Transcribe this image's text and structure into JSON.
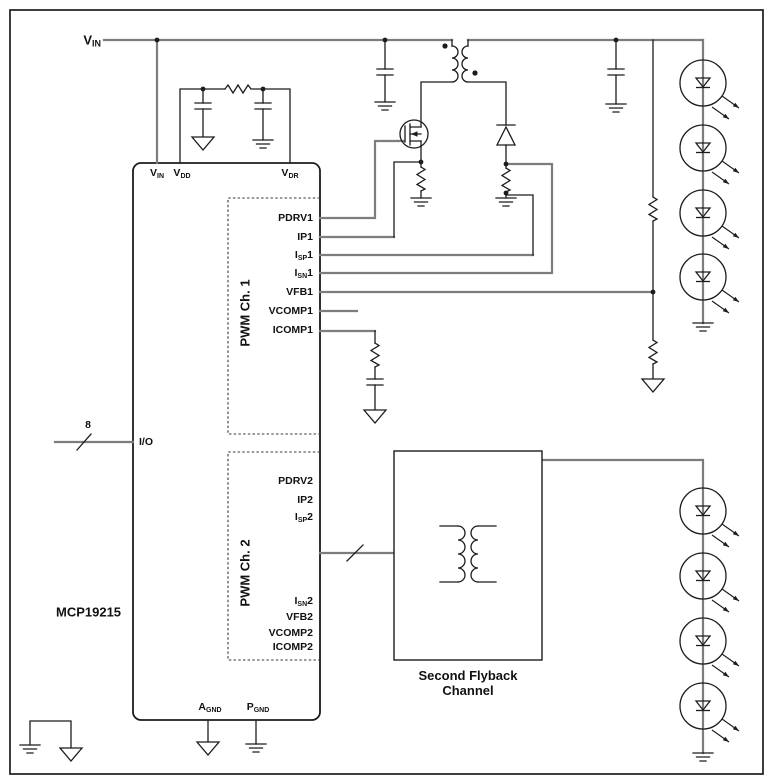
{
  "nets": {
    "vin": {
      "pre": "V",
      "sub": "IN"
    },
    "io_bus_width": "8"
  },
  "chip": {
    "name": "MCP19215",
    "top_pins": [
      {
        "pre": "V",
        "sub": "IN"
      },
      {
        "pre": "V",
        "sub": "DD"
      },
      {
        "pre": "V",
        "sub": "DR"
      }
    ],
    "left_pins": [
      {
        "pre": "I/O",
        "sub": ""
      }
    ],
    "bottom_pins": [
      {
        "pre": "A",
        "sub": "GND"
      },
      {
        "pre": "P",
        "sub": "GND"
      }
    ],
    "pwm_ch1": {
      "label": "PWM Ch. 1",
      "pins": [
        {
          "pre": "PDRV1",
          "sub": "",
          "post": ""
        },
        {
          "pre": "IP1",
          "sub": "",
          "post": ""
        },
        {
          "pre": "I",
          "sub": "SP",
          "post": "1"
        },
        {
          "pre": "I",
          "sub": "SN",
          "post": "1"
        },
        {
          "pre": "VFB1",
          "sub": "",
          "post": ""
        },
        {
          "pre": "VCOMP1",
          "sub": "",
          "post": ""
        },
        {
          "pre": "ICOMP1",
          "sub": "",
          "post": ""
        }
      ]
    },
    "pwm_ch2": {
      "label": "PWM Ch. 2",
      "pins": [
        {
          "pre": "PDRV2",
          "sub": "",
          "post": ""
        },
        {
          "pre": "IP2",
          "sub": "",
          "post": ""
        },
        {
          "pre": "I",
          "sub": "SP",
          "post": "2"
        },
        {
          "pre": "I",
          "sub": "SN",
          "post": "2"
        },
        {
          "pre": "VFB2",
          "sub": "",
          "post": ""
        },
        {
          "pre": "VCOMP2",
          "sub": "",
          "post": ""
        },
        {
          "pre": "ICOMP2",
          "sub": "",
          "post": ""
        }
      ]
    }
  },
  "blocks": {
    "second_flyback": {
      "line1": "Second Flyback",
      "line2": "Channel"
    }
  },
  "leds": {
    "string1_count": 4,
    "string2_count": 4
  },
  "colors": {
    "wire": "#1c1c1c",
    "route_wire": "#7d7d7d",
    "background": "#ffffff"
  }
}
